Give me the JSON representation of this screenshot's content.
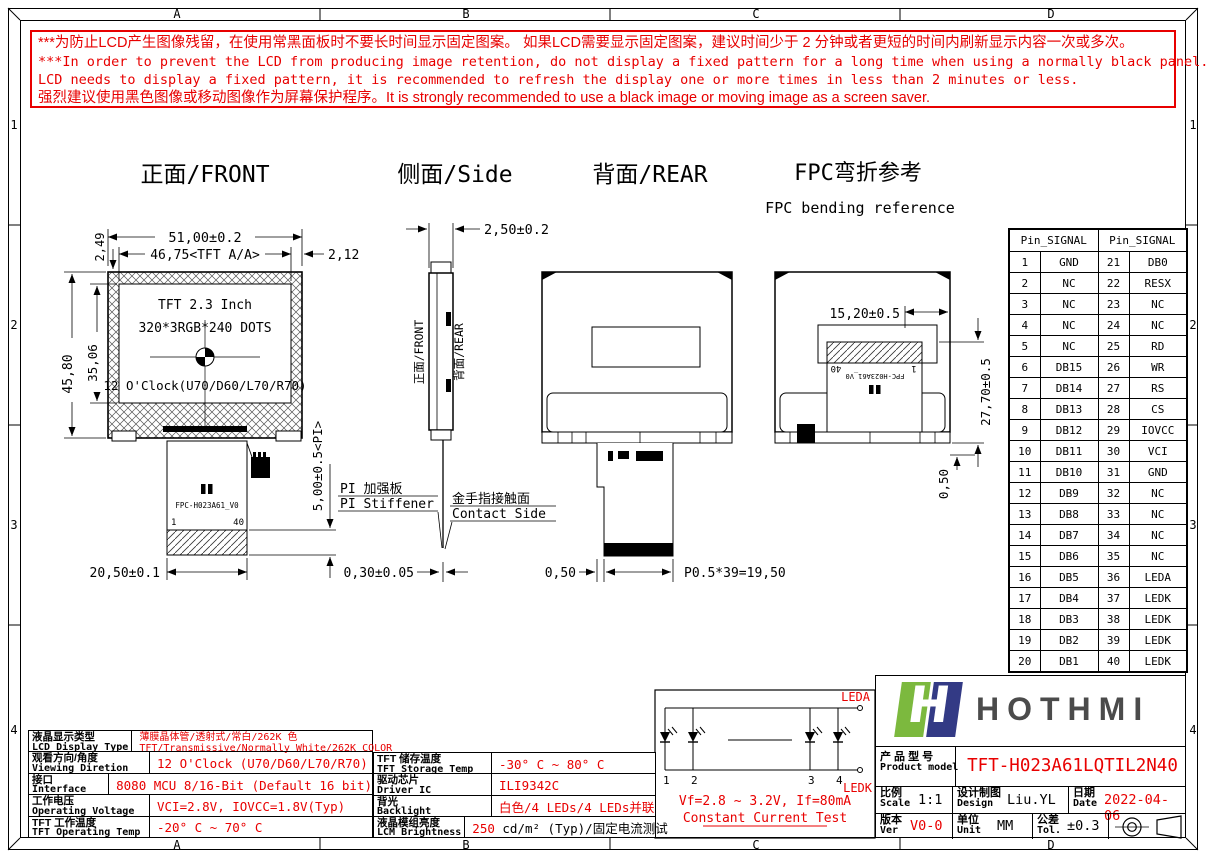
{
  "frame": {
    "cols": [
      "A",
      "B",
      "C",
      "D"
    ],
    "rows": [
      "1",
      "2",
      "3",
      "4"
    ]
  },
  "warning": {
    "l1": "***为防止LCD产生图像残留，在使用常黑面板时不要长时间显示固定图案。 如果LCD需要显示固定图案，建议时间少于 2 分钟或者更短的时间内刷新显示内容一次或多次。",
    "l2": "***In order to prevent the LCD from producing image retention, do not display a fixed pattern for a long time when using a normally black panel. If the",
    "l3": " LCD needs to display a fixed pattern, it is recommended to refresh the display one or more times in less than 2 minutes or less.",
    "l4": "强烈建议使用黑色图像或移动图像作为屏幕保护程序。It is strongly recommended to use a black image or moving image as a screen saver."
  },
  "views": {
    "front": {
      "title": "正面/FRONT",
      "screen_line1": "TFT 2.3 Inch",
      "screen_line2": "320*3RGB*240 DOTS",
      "screen_line3": "12 O'Clock(U70/D60/L70/R70)",
      "dim_width": "51,00±0.2",
      "dim_aa": "46,75<TFT A/A>",
      "dim_right": "2,12",
      "dim_top_border": "2,49",
      "dim_height": "45,80",
      "dim_aa_height": "35,06",
      "dim_fpc_width": "20,50±0.1",
      "dim_stiffener": "5,00±0.5<PI>",
      "dim_fpc_thickness": "0,30±0.05",
      "stiffener_zh": "PI 加强板",
      "stiffener_en": "PI Stiffener",
      "fpc_label": "FPC-H023A61_V0",
      "pin_first": "1",
      "pin_last": "40"
    },
    "side": {
      "title": "侧面/Side",
      "dim_thickness": "2,50±0.2",
      "front_label": "正面/FRONT",
      "rear_label": "背面/REAR",
      "contact_zh": "金手指接触面",
      "contact_en": "Contact Side"
    },
    "rear": {
      "title": "背面/REAR",
      "dim_pin": "0,50",
      "dim_pitch": "P0.5*39=19,50"
    },
    "bend": {
      "title": "FPC弯折参考",
      "subtitle": "FPC bending reference",
      "dim_width": "15,20±0.5",
      "dim_height": "27,70±0.5",
      "dim_bottom": "0,50",
      "fpc_label": "FPC-H023A61_V0",
      "pin_first": "1",
      "pin_last": "40"
    }
  },
  "pin_table": {
    "header": "Pin_SIGNAL",
    "rows": [
      {
        "p1": "1",
        "s1": "GND",
        "p2": "21",
        "s2": "DB0"
      },
      {
        "p1": "2",
        "s1": "NC",
        "p2": "22",
        "s2": "RESX"
      },
      {
        "p1": "3",
        "s1": "NC",
        "p2": "23",
        "s2": "NC"
      },
      {
        "p1": "4",
        "s1": "NC",
        "p2": "24",
        "s2": "NC"
      },
      {
        "p1": "5",
        "s1": "NC",
        "p2": "25",
        "s2": "RD"
      },
      {
        "p1": "6",
        "s1": "DB15",
        "p2": "26",
        "s2": "WR"
      },
      {
        "p1": "7",
        "s1": "DB14",
        "p2": "27",
        "s2": "RS"
      },
      {
        "p1": "8",
        "s1": "DB13",
        "p2": "28",
        "s2": "CS"
      },
      {
        "p1": "9",
        "s1": "DB12",
        "p2": "29",
        "s2": "IOVCC"
      },
      {
        "p1": "10",
        "s1": "DB11",
        "p2": "30",
        "s2": "VCI"
      },
      {
        "p1": "11",
        "s1": "DB10",
        "p2": "31",
        "s2": "GND"
      },
      {
        "p1": "12",
        "s1": "DB9",
        "p2": "32",
        "s2": "NC"
      },
      {
        "p1": "13",
        "s1": "DB8",
        "p2": "33",
        "s2": "NC"
      },
      {
        "p1": "14",
        "s1": "DB7",
        "p2": "34",
        "s2": "NC"
      },
      {
        "p1": "15",
        "s1": "DB6",
        "p2": "35",
        "s2": "NC"
      },
      {
        "p1": "16",
        "s1": "DB5",
        "p2": "36",
        "s2": "LEDA"
      },
      {
        "p1": "17",
        "s1": "DB4",
        "p2": "37",
        "s2": "LEDK"
      },
      {
        "p1": "18",
        "s1": "DB3",
        "p2": "38",
        "s2": "LEDK"
      },
      {
        "p1": "19",
        "s1": "DB2",
        "p2": "39",
        "s2": "LEDK"
      },
      {
        "p1": "20",
        "s1": "DB1",
        "p2": "40",
        "s2": "LEDK"
      }
    ]
  },
  "spec_left": {
    "rows": [
      {
        "zh": "液晶显示类型",
        "en": "LCD Display Type",
        "lines": [
          [
            {
              "t": "薄膜晶体管/透射式/常白/262K 色",
              "red": true
            }
          ],
          [
            {
              "t": "TFT/Transmissive/Normally White/262K COLOR",
              "red": true
            }
          ]
        ]
      },
      {
        "zh": "观看方向/角度",
        "en": "Viewing Diretion",
        "lines": [
          [
            {
              "t": "12 O'Clock (U70/D60/L70/R70)",
              "red": true
            }
          ]
        ]
      },
      {
        "zh": "接口",
        "en": "Interface",
        "lines": [
          [
            {
              "t": "8080 MCU 8/16-Bit (Default 16 bit)",
              "red": true
            }
          ]
        ]
      },
      {
        "zh": "工作电压",
        "en": "Operating Voltage",
        "lines": [
          [
            {
              "t": "VCI=2.8V, IOVCC=1.8V(Typ)",
              "red": true
            }
          ]
        ]
      },
      {
        "zh": "TFT 工作温度",
        "en": "TFT Operating Temp",
        "lines": [
          [
            {
              "t": "-20° C ~ 70° C",
              "red": true
            }
          ]
        ]
      }
    ]
  },
  "spec_right": {
    "rows": [
      {
        "zh": "TFT 储存温度",
        "en": "TFT Storage Temp",
        "lines": [
          [
            {
              "t": "-30° C ~ 80° C",
              "red": true
            }
          ]
        ]
      },
      {
        "zh": "驱动芯片",
        "en": "Driver IC",
        "lines": [
          [
            {
              "t": "ILI9342C",
              "red": true
            }
          ]
        ]
      },
      {
        "zh": "背光",
        "en": "Backlight",
        "lines": [
          [
            {
              "t": "白色/4 LEDs/4 LEDs并联",
              "red": true
            }
          ]
        ]
      },
      {
        "zh": "液晶模组亮度",
        "en": "LCM Brightness",
        "lines": [
          [
            {
              "t": "250",
              "red": true
            },
            {
              "t": " cd/m² (Typ)/固定电流测试",
              "red": false
            }
          ]
        ]
      }
    ]
  },
  "led_circuit": {
    "leda": "LEDA",
    "ledk": "LEDK",
    "nums": [
      "1",
      "2",
      "3",
      "4"
    ],
    "vf": "Vf=2.8 ~ 3.2V, If=80mA",
    "test": "Constant Current Test"
  },
  "title_block": {
    "brand": "HOTHMI",
    "logo_letter": "H",
    "product_zh": "产 品 型 号",
    "product_en": "Product model",
    "model": "TFT-H023A61LQTIL2N40",
    "scale_zh": "比例",
    "scale_en": "Scale",
    "scale": "1:1",
    "design_zh": "设计制图",
    "design_en": "Design",
    "designer": "Liu.YL",
    "date_zh": "日期",
    "date_en": "Date",
    "date": "2022-04-06",
    "ver_zh": "版本",
    "ver_en": "Ver",
    "ver": "V0-0",
    "unit_zh": "单位",
    "unit_en": "Unit",
    "unit": "MM",
    "tol_zh": "公差",
    "tol_en": "Tol.",
    "tol": "±0.3"
  },
  "colors": {
    "accent_red": "#e80000",
    "logo_green": "#7cb93e",
    "logo_navy": "#333a85",
    "brand_gray": "#4b4b4b"
  }
}
